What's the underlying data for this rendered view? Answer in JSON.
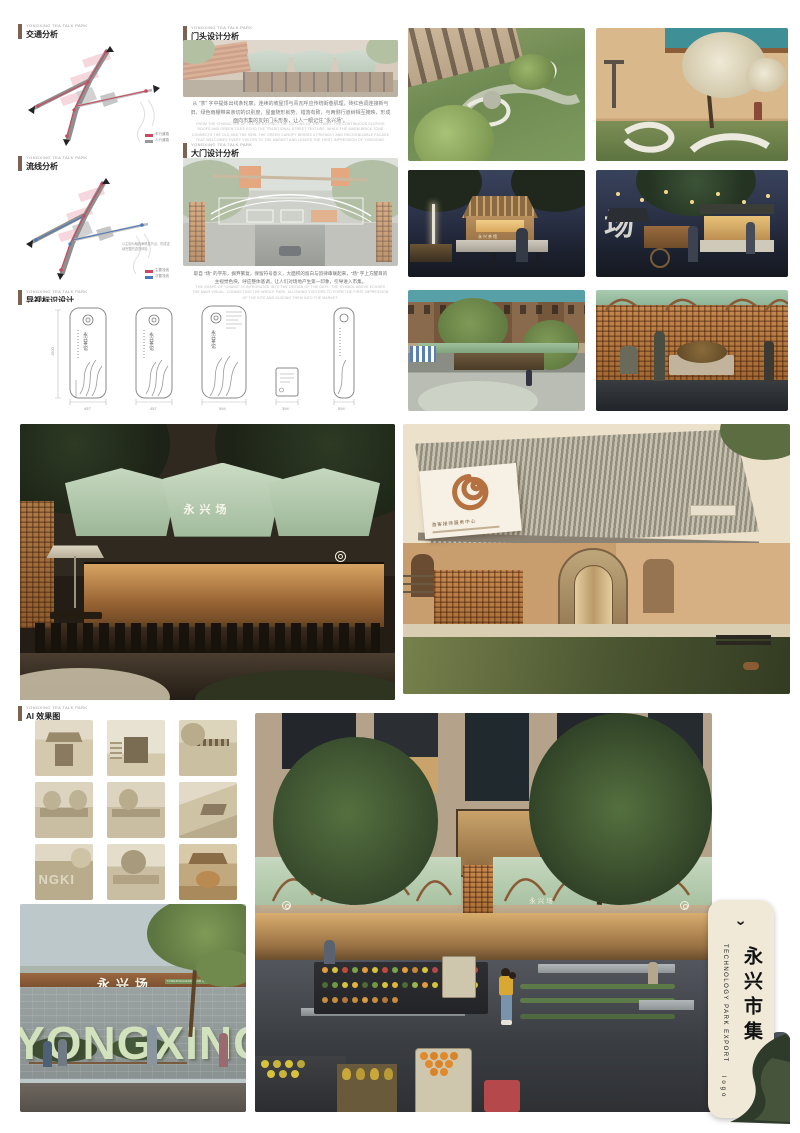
{
  "brand": "YONGXING TEA TALK PARK",
  "colors": {
    "accent_red": "#c9495e",
    "route_blue": "#4e79b8",
    "awning_green": "#bfd4ba",
    "brick": "#b5713f",
    "night_sky": "#2a3146",
    "sepia": "#dcd3c0",
    "card_bg": "#f0e9d8"
  },
  "sections": {
    "traffic": {
      "title": "交通分析",
      "legend": [
        {
          "label": "车行道路",
          "color": "#c9495e"
        },
        {
          "label": "人行道路",
          "color": "#9a9a9a"
        }
      ]
    },
    "circulation": {
      "title": "流线分析",
      "legend": [
        {
          "label": "主要流线",
          "color": "#c9495e"
        },
        {
          "label": "次要流线",
          "color": "#4e79b8"
        }
      ],
      "note": "以主街为轴线串联各节点，形成连续完整的游览体验"
    },
    "signage": {
      "title": "导视标识设计",
      "sign_label": "永兴茶馆",
      "height_dim": "1500",
      "width_dims": [
        "457",
        "457",
        "594",
        "394",
        "594"
      ]
    },
    "storefront": {
      "title": "门头设计分析",
      "body_cn": "从 “茶” 字中提炼出线条轮廓，连续的坡屋顶与青瓦呼应传统街巷肌理，砖红色调连接新与旧，绿色雨棚带来亲切的识别度，屋面随形就势、错落有致，与两侧行道树相互掩映，形成面向市集的友好门头形象，让人一眼记住 “永兴场”。",
      "body_en": "FROM THE CHARACTER OF TEA WE EXTRACT THE OUTLINE OF THE LINES. THE CONTINUOUS SLOPING ROOFS AND GREEN TILES ECHO THE TRADITIONAL STREET TEXTURE, WHILE THE WARM BRICK TONE CONNECTS THE OLD AND THE NEW. THE GREEN CANOPY BRINGS A FRIENDLY AND RECOGNIZABLE FACADE THAT WELCOMES EVERY VISITOR TO THE MARKET AND LEAVES THE FIRST IMPRESSION OF YONGXING."
    },
    "gate": {
      "title": "大门设计分析",
      "body_cn": "取自 “场” 的字形，摒弃繁复，保留符号意义，大面积的留白与韵律串联起来，“场” 字上方醒目的主视觉色块，呼应整体基调，让人们对场地产生第一印象，引导进入市集。",
      "body_en": "THE SHAPE OF “CHANG” IS INTEGRATED INTO THE DESIGN OF THE GATE. THE SYMBOL ABOVE ECHOES THE MAIN VISUAL, CONNECTING THE WHOLE PARK, ALLOWING VISITORS TO FORM THE FIRST IMPRESSION OF THE SITE AND GUIDING THEM INTO THE MARKET."
    },
    "ai": {
      "title": "AI 效果图"
    }
  },
  "renderings": {
    "kiosk_sign": "永兴茶馆",
    "cart_sign": "场",
    "hero_left_awning": "永兴场",
    "hero_right_sign": "游客接待服务中心",
    "wall_sign": "永兴场",
    "wall_badge": "YONGXINGCHANG AND CULTURE",
    "wall_letters": "YONGXING",
    "market_awning": "永兴场"
  },
  "card": {
    "chevron": "›",
    "en": "TECHNOLOGY PARK EXPORT",
    "cn": "永兴市集",
    "logo": "logo"
  }
}
